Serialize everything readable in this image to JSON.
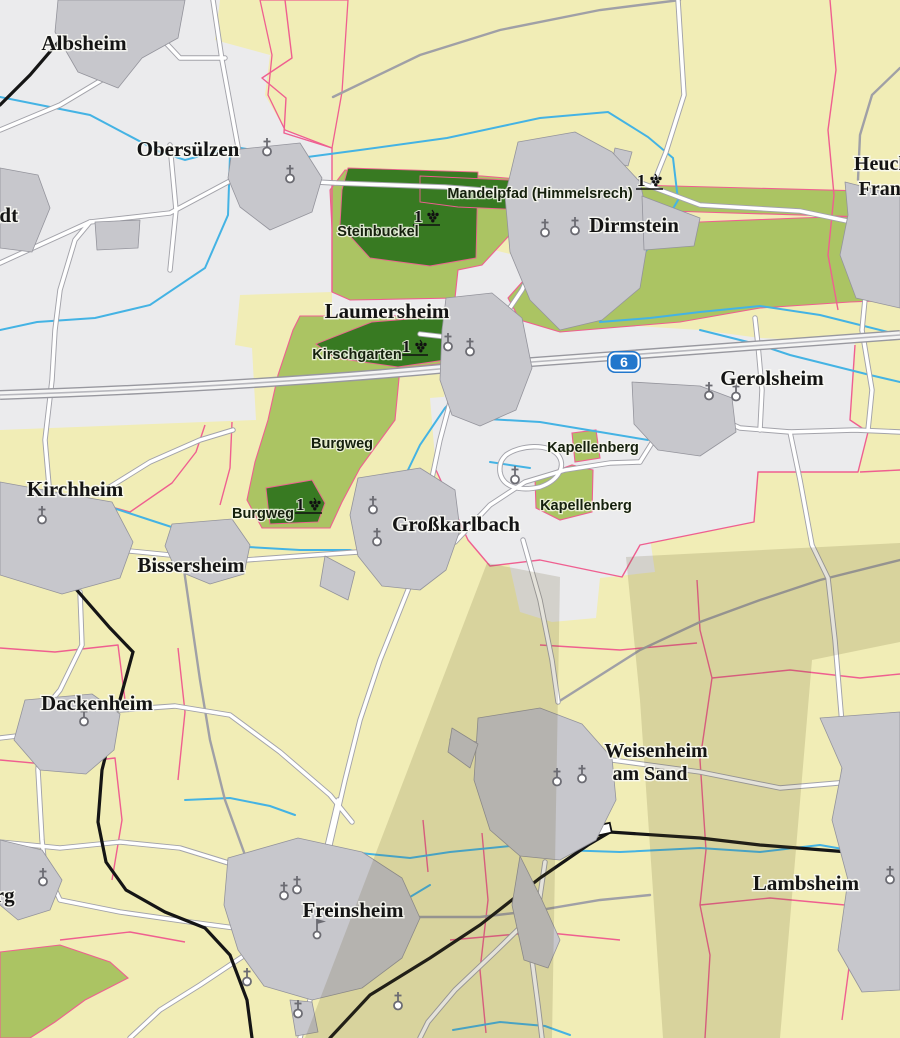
{
  "map": {
    "labels": {
      "towns": [
        {
          "name": "Albsheim"
        },
        {
          "name": "Obersülzen"
        },
        {
          "name": "Dirmstein"
        },
        {
          "name": "Laumersheim"
        },
        {
          "name": "Gerolsheim"
        },
        {
          "name": "Großkarlbach"
        },
        {
          "name": "Kirchheim"
        },
        {
          "name": "Bissersheim"
        },
        {
          "name": "Dackenheim"
        },
        {
          "name": "Freinsheim"
        },
        {
          "name": "Lambsheim"
        },
        {
          "name": "Weisenheim",
          "name_line2": "am Sand"
        },
        {
          "name": "Heuchelheim",
          "name_line2": "Frankenthal"
        }
      ],
      "partial_towns": [
        {
          "name": "tadt"
        },
        {
          "name": "erg"
        }
      ],
      "vineyards": [
        {
          "name": "Steinbuckel",
          "classified": true
        },
        {
          "name": "Mandelpfad (Himmelsrech)",
          "classified": true
        },
        {
          "name": "Kirschgarten",
          "classified": true
        },
        {
          "name": "Burgweg",
          "classified": false
        },
        {
          "name": "Burgweg",
          "classified": true
        },
        {
          "name": "Kapellenberg",
          "classified": false
        },
        {
          "name": "Kapellenberg",
          "classified": false
        }
      ],
      "symbols": {
        "erste_lage": "1",
        "motorway": "6"
      }
    },
    "colors": {
      "farmland": "#f1edb6",
      "open_land": "#ebebed",
      "vineyard": "#abc463",
      "vineyard_premium": "#387a22",
      "settlement": "#c7c7cc",
      "water": "#44b3e4",
      "boundary": "#ef5f90",
      "railway": "#151515",
      "road": "#ffffff",
      "motorway_shield": "#2277cc",
      "shadow_band": "#d8d39e"
    }
  }
}
